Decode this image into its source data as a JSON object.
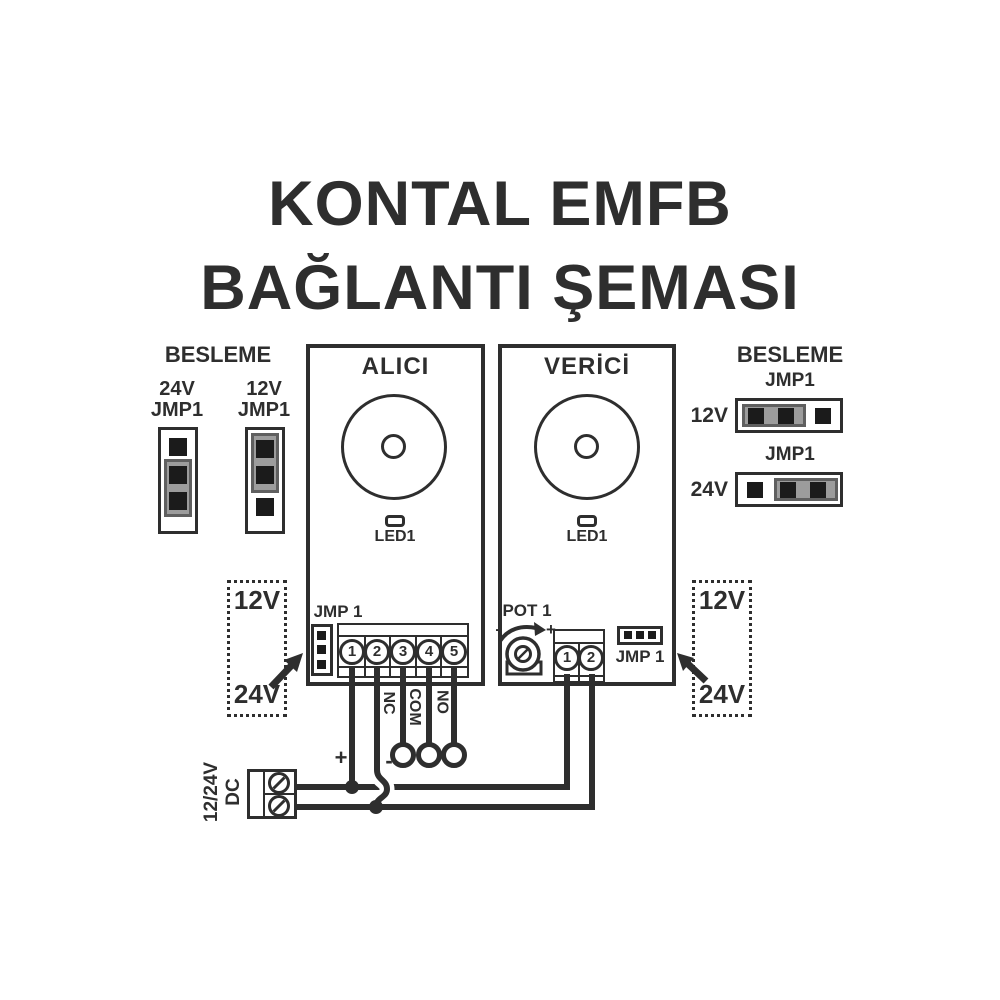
{
  "colors": {
    "line": "#2e2e2e",
    "pin": "#1b1b1b",
    "jumper": "#9c9c9c",
    "jumper_border": "#5f5f5f",
    "bg": "#ffffff"
  },
  "title": {
    "line1": "KONTAL EMFB",
    "line2": "BAĞLANTI ŞEMASI"
  },
  "left_panel": {
    "heading": "BESLEME",
    "jumper_24v": {
      "line1": "24V",
      "line2": "JMP1"
    },
    "jumper_12v": {
      "line1": "12V",
      "line2": "JMP1"
    }
  },
  "right_panel": {
    "heading": "BESLEME",
    "row_12v": {
      "jmp_label": "JMP1",
      "voltage": "12V"
    },
    "row_24v": {
      "jmp_label": "JMP1",
      "voltage": "24V"
    }
  },
  "alici": {
    "title": "ALICI",
    "led_label": "LED1",
    "jmp_label": "JMP 1",
    "terminals": [
      "1",
      "2",
      "3",
      "4",
      "5"
    ]
  },
  "verici": {
    "title": "VERİCİ",
    "led_label": "LED1",
    "pot_label": "POT 1",
    "pot_minus": "-",
    "pot_plus": "+",
    "jmp_label": "JMP 1",
    "terminals": [
      "1",
      "2"
    ]
  },
  "voltage_note_left": {
    "top": "12V",
    "bottom": "24V"
  },
  "voltage_note_right": {
    "top": "12V",
    "bottom": "24V"
  },
  "wiring": {
    "plus": "+",
    "minus": "-",
    "relay_outputs": [
      "NC",
      "COM",
      "NO"
    ],
    "dc_label_line1": "12/24V",
    "dc_label_line2": "DC"
  }
}
